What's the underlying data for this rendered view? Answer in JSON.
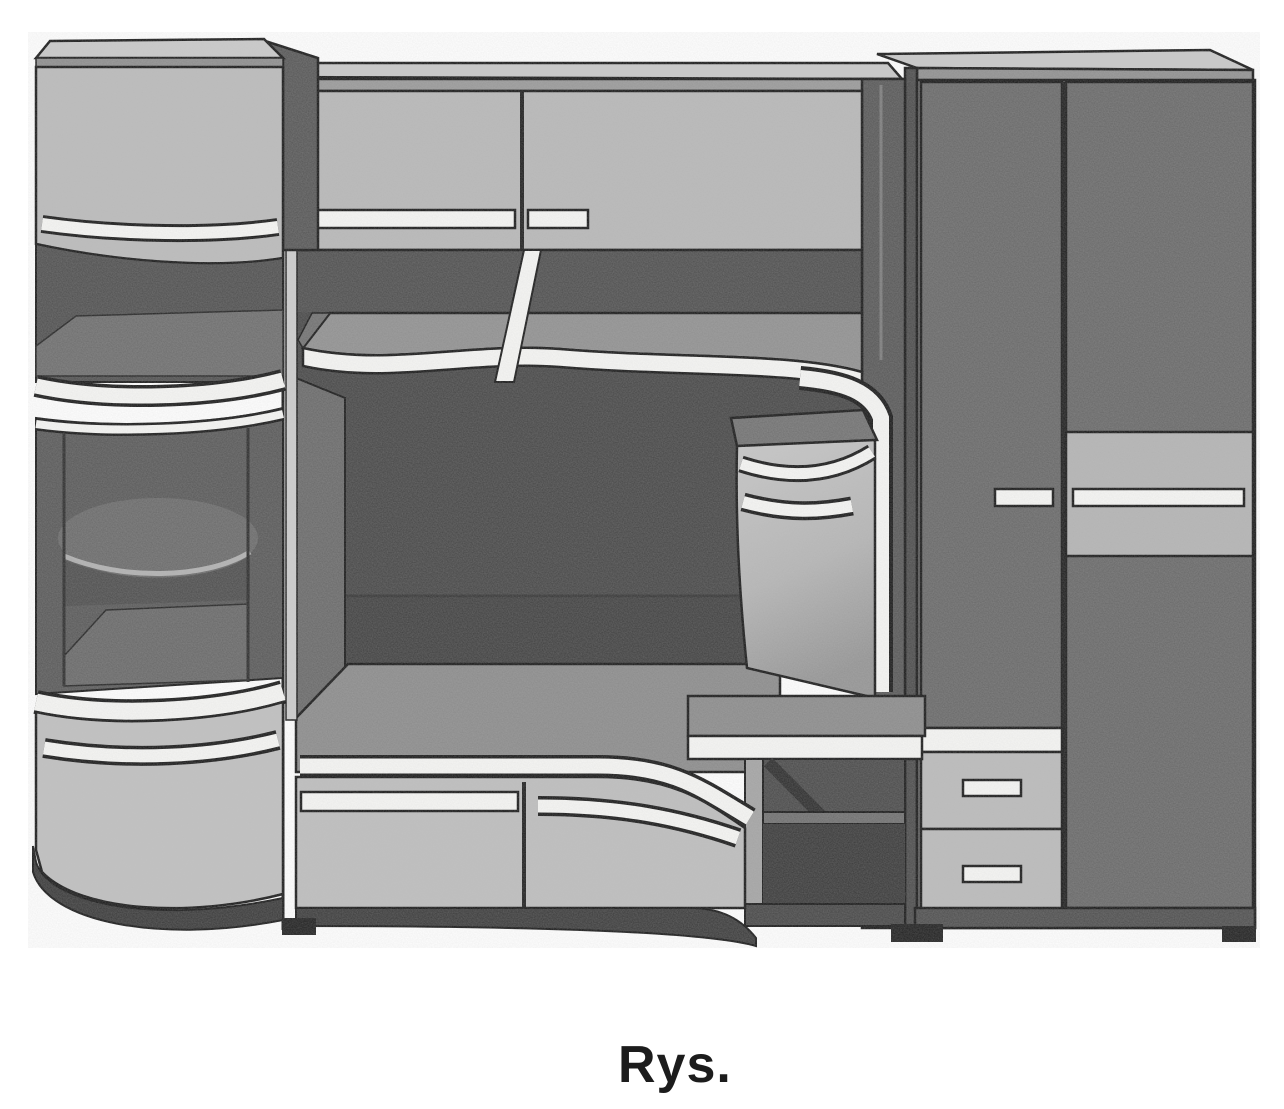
{
  "caption": {
    "label": "Rys."
  },
  "figure": {
    "title": "Furniture wall-unit set, scanned grayscale illustration",
    "type": "line-drawing",
    "components": [
      "left curved display cabinet with glass case",
      "upper two-door cabinet with bar handles",
      "open shelf with wavy front edge and center post",
      "dark alcove niche",
      "bench cabinet with two wavy drawers",
      "hanging corner cabinet with curved front",
      "desk top with open compartment",
      "two-door wardrobe with long bar handle",
      "two-drawer side chest"
    ],
    "palette": {
      "paper": "#ffffff",
      "outline": "#161616",
      "door_light": "#b9b9b9",
      "shelf_mid": "#8f8f8f",
      "panel_dark": "#666666",
      "interior_dark": "#474747",
      "highlight_white": "#f6f6f4",
      "base_dark": "#3a3a3a"
    }
  }
}
